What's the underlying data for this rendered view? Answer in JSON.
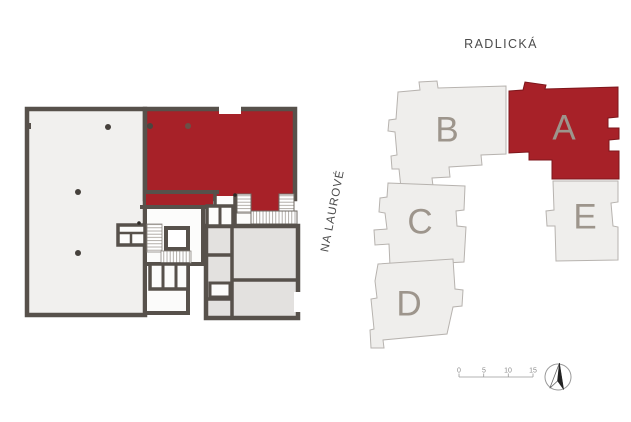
{
  "site_plan": {
    "street_top": "RADLICKÁ",
    "street_left": "NA LAUROVÉ",
    "buildings": [
      {
        "label": "B",
        "highlighted": false
      },
      {
        "label": "A",
        "highlighted": true
      },
      {
        "label": "C",
        "highlighted": false
      },
      {
        "label": "D",
        "highlighted": false
      },
      {
        "label": "E",
        "highlighted": false
      }
    ],
    "scale_ticks": [
      "0",
      "5",
      "10",
      "15"
    ],
    "compass": "north-arrow"
  },
  "floor_plan": {
    "highlighted_unit": "red unit, top-right of plan"
  },
  "colors": {
    "highlight_red": "#a72128",
    "building_fill": "#efeeec",
    "building_stroke": "#b7b3af",
    "wall": "#57514b",
    "room_light": "#f1f0ee",
    "room_gray": "#e3e1df",
    "label_gray": "#9d958c",
    "street_text": "#4c4c4c"
  }
}
